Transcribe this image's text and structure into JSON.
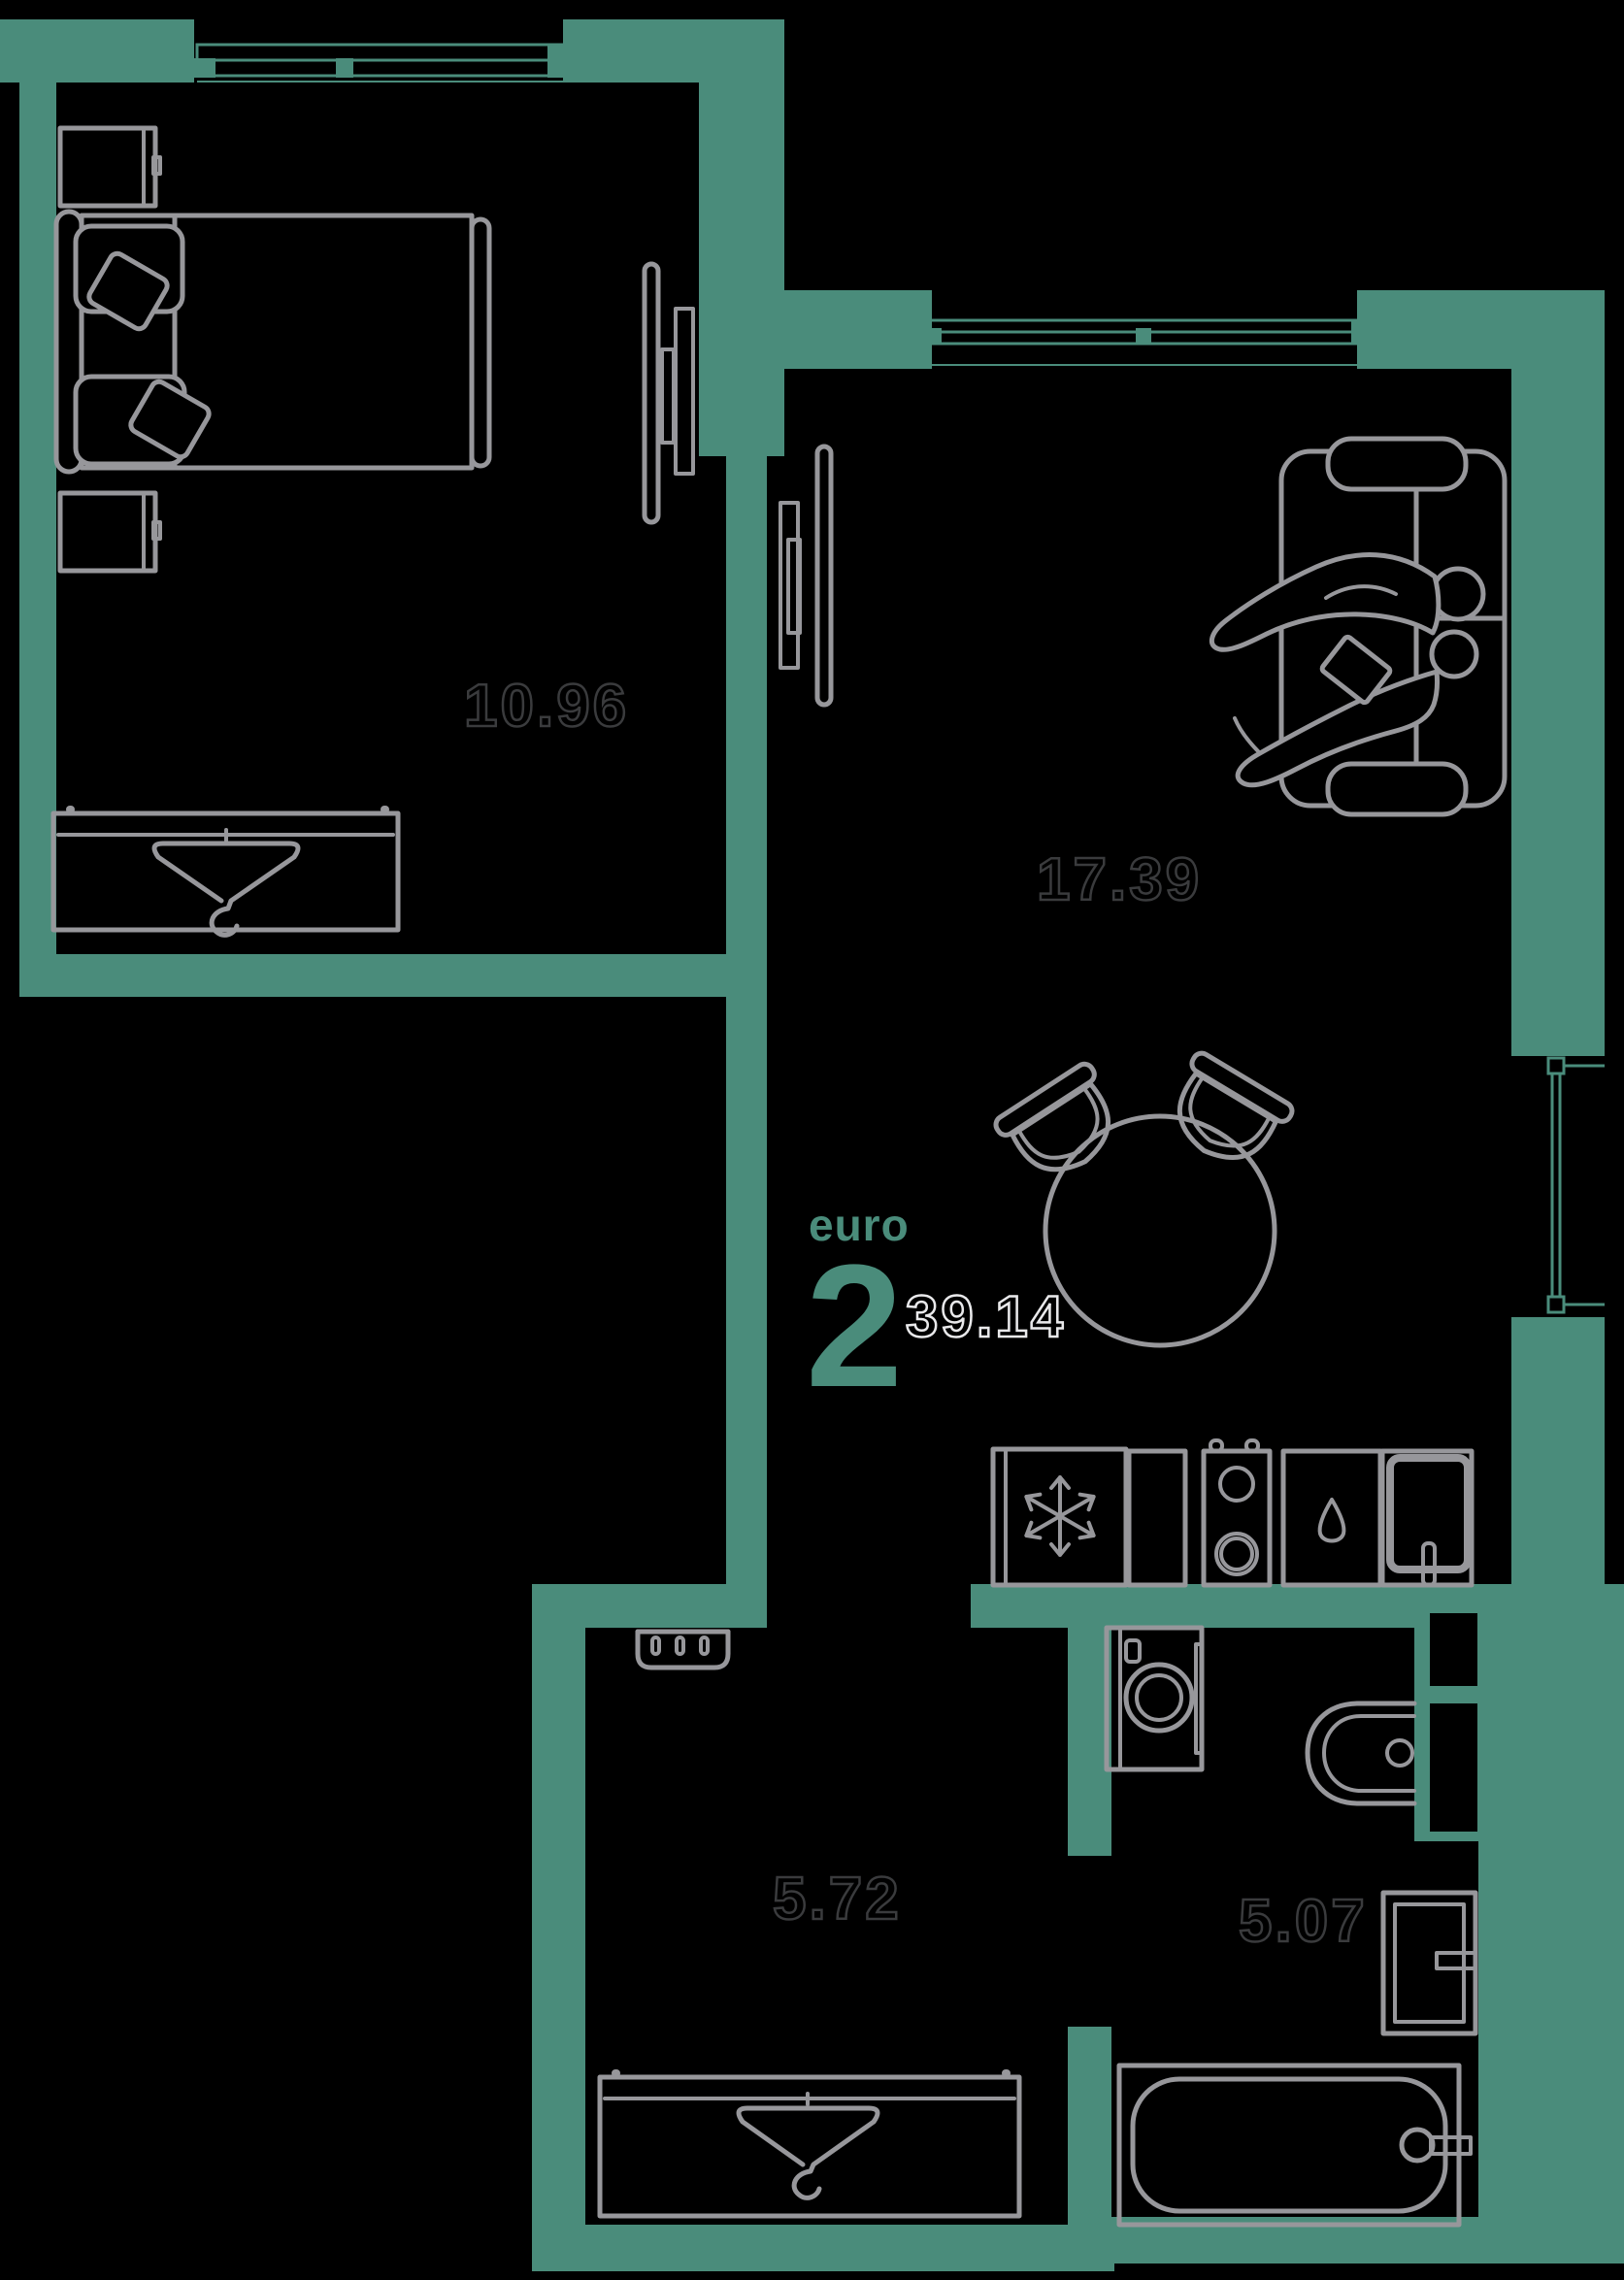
{
  "apartment": {
    "type_label": "euro",
    "rooms_count": "2",
    "total_area": "39.14"
  },
  "rooms": [
    {
      "name": "bedroom",
      "area": "10.96"
    },
    {
      "name": "living-kitchen",
      "area": "17.39"
    },
    {
      "name": "hallway",
      "area": "5.72"
    },
    {
      "name": "bathroom",
      "area": "5.07"
    }
  ],
  "colors": {
    "background": "#000000",
    "walls": "#4a8c7b",
    "furniture_outline": "#97979b",
    "room_area_text": "#3a3b3d",
    "total_area_text": "#e9e9eb",
    "accent_text": "#4a8c7b"
  },
  "icons": [
    "window-icon",
    "hanger-icon",
    "snowflake-icon",
    "stove-burners-icon",
    "kitchen-sink-icon",
    "washing-machine-icon",
    "toilet-icon",
    "bathtub-icon",
    "bathroom-sink-icon",
    "tv-icon",
    "sofa-icon",
    "bed-icon",
    "pillow-icon",
    "dining-table-icon",
    "chair-icon",
    "shoe-rack-icon",
    "nightstand-icon",
    "wardrobe-icon",
    "people-on-sofa-icon",
    "balcony-window-icon"
  ]
}
